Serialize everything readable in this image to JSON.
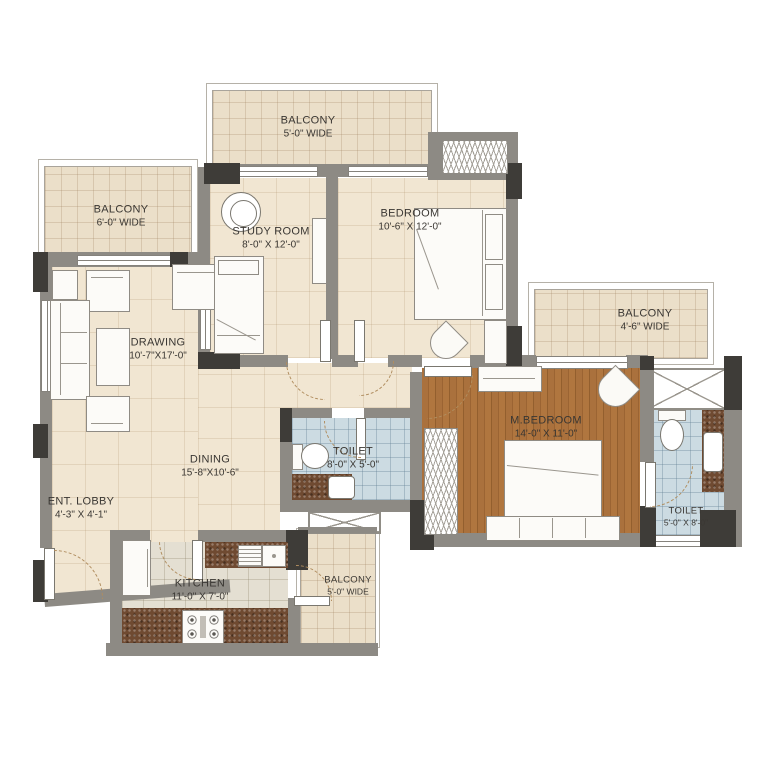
{
  "title": "Apartment floor plan (2.5 BHK unit)",
  "rooms": {
    "balcony_top_left": {
      "name": "BALCONY",
      "dims": "6'-0\" WIDE"
    },
    "balcony_top": {
      "name": "BALCONY",
      "dims": "5'-0\" WIDE"
    },
    "study_room": {
      "name": "STUDY ROOM",
      "dims": "8'-0\" X 12'-0\""
    },
    "bedroom": {
      "name": "BEDROOM",
      "dims": "10'-6\" X 12'-0\""
    },
    "balcony_right": {
      "name": "BALCONY",
      "dims": "4'-6\" WIDE"
    },
    "drawing": {
      "name": "DRAWING",
      "dims": "10'-7\"X17'-0\""
    },
    "dining": {
      "name": "DINING",
      "dims": "15'-8\"X10'-6\""
    },
    "ent_lobby": {
      "name": "ENT. LOBBY",
      "dims": "4'-3\" X 4'-1\""
    },
    "toilet_mid": {
      "name": "TOILET",
      "dims": "8'-0\" X 5'-0\""
    },
    "m_bedroom": {
      "name": "M.BEDROOM",
      "dims": "14'-0\" X 11'-0\""
    },
    "toilet_right": {
      "name": "TOILET",
      "dims": "5'-0\" X 8'-0\""
    },
    "kitchen": {
      "name": "KITCHEN",
      "dims": "11'-0\" X 7'-0\""
    },
    "balcony_bottom": {
      "name": "BALCONY",
      "dims": "5'-0\" WIDE"
    }
  },
  "colors": {
    "wall": "#8d8a84",
    "column": "#3e3c38",
    "floor": "#f1e6d2",
    "balcony": "#ebdfc9",
    "wood": "#a8703c",
    "tile": "#ccdbe2",
    "kitchen_floor": "#e4dfd2",
    "counter": "#6f4a31",
    "label": "#3a3733"
  }
}
